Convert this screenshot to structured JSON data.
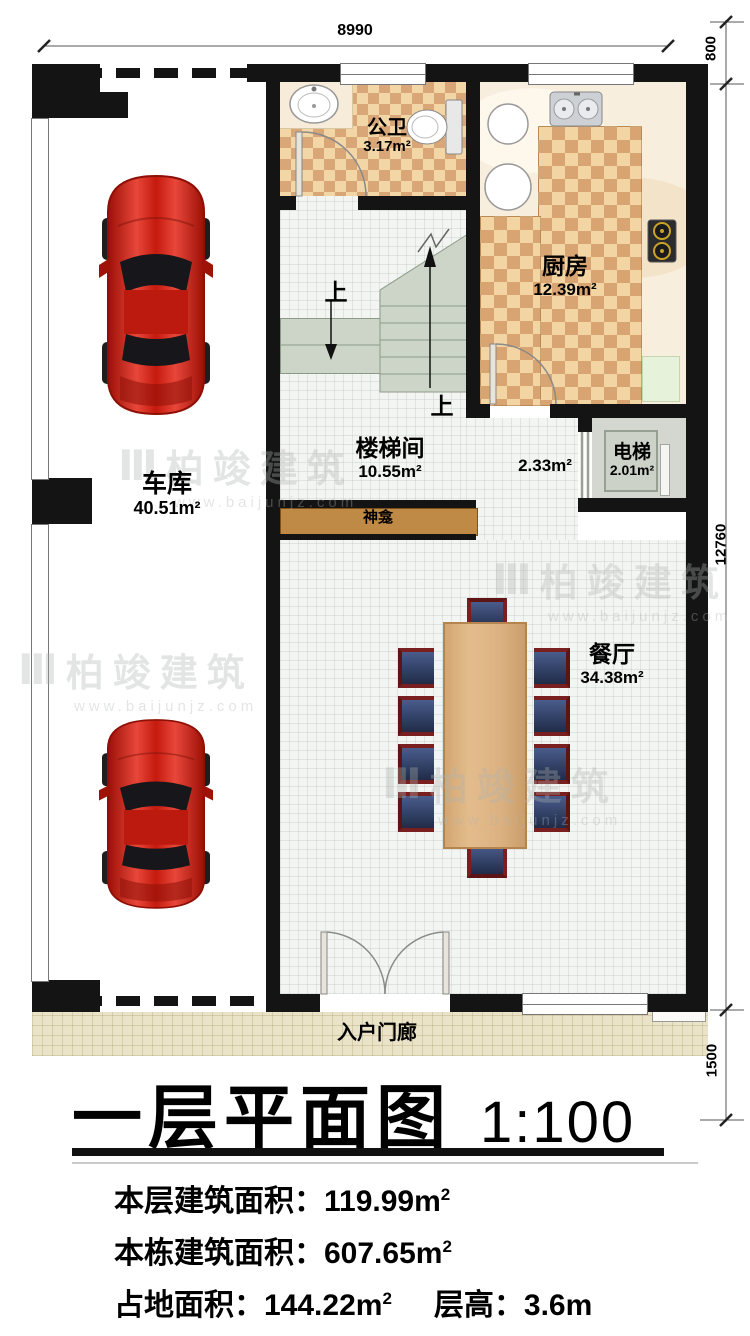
{
  "plan": {
    "rooms": {
      "garage": {
        "name": "车库",
        "area": "40.51m²"
      },
      "bathroom": {
        "name": "公卫",
        "area": "3.17m²"
      },
      "kitchen": {
        "name": "厨房",
        "area": "12.39m²"
      },
      "stairwell": {
        "name": "楼梯间",
        "area": "10.55m²"
      },
      "hallway": {
        "area": "2.33m²"
      },
      "elevator": {
        "name": "电梯",
        "area": "2.01m²"
      },
      "shrine": {
        "name": "神龛"
      },
      "dining": {
        "name": "餐厅",
        "area": "34.38m²"
      },
      "porch": {
        "name": "入户门廊"
      }
    },
    "stairs": {
      "up_label": "上"
    },
    "dimensions": {
      "top_width": "8990",
      "right_top": "800",
      "right_middle": "12760",
      "right_bottom": "1500"
    }
  },
  "title": {
    "text": "一层平面图",
    "scale": "1:100"
  },
  "stats": {
    "line1_label": "本层建筑面积：",
    "line1_value": "119.99m",
    "line1_sup": "2",
    "line2_label": "本栋建筑面积：",
    "line2_value": "607.65m",
    "line2_sup": "2",
    "line3a_label": "占地面积：",
    "line3a_value": "144.22m",
    "line3a_sup": "2",
    "line3b_label": "层高：",
    "line3b_value": "3.6m"
  },
  "watermark": {
    "logo": "Ⅲ",
    "brand": "柏竣建筑",
    "url": "www.baijunjz.com"
  }
}
